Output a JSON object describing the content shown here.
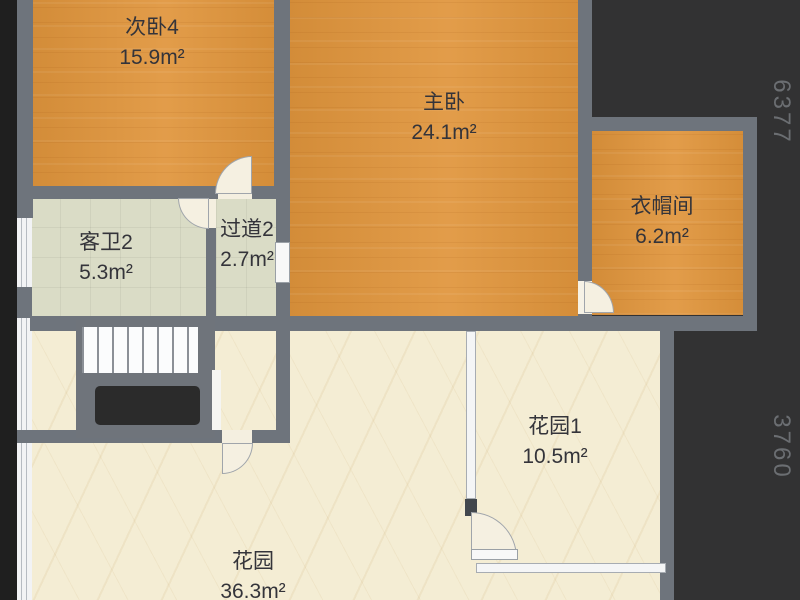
{
  "plan": {
    "type": "floor-plan",
    "rooms": [
      {
        "name": "次卧4",
        "area": "15.9m²",
        "kind": "bedroom"
      },
      {
        "name": "主卧",
        "area": "24.1m²",
        "kind": "master-bedroom"
      },
      {
        "name": "衣帽间",
        "area": "6.2m²",
        "kind": "cloakroom"
      },
      {
        "name": "客卫2",
        "area": "5.3m²",
        "kind": "bathroom"
      },
      {
        "name": "过道2",
        "area": "2.7m²",
        "kind": "hallway"
      },
      {
        "name": "花园1",
        "area": "10.5m²",
        "kind": "garden"
      },
      {
        "name": "花园",
        "area": "36.3m²",
        "kind": "garden"
      }
    ],
    "dimensions": {
      "right_upper": "6377",
      "right_lower": "3760"
    },
    "colors": {
      "wood_floor": "#e0953c",
      "marble_floor": "#f4edd4",
      "tile_floor": "#dadcc6",
      "wall": "#6e747c",
      "background": "#323233",
      "stair_void": "#2b2b2b",
      "label_text": "#34343a",
      "dimension_text": "#6b6e72"
    }
  }
}
